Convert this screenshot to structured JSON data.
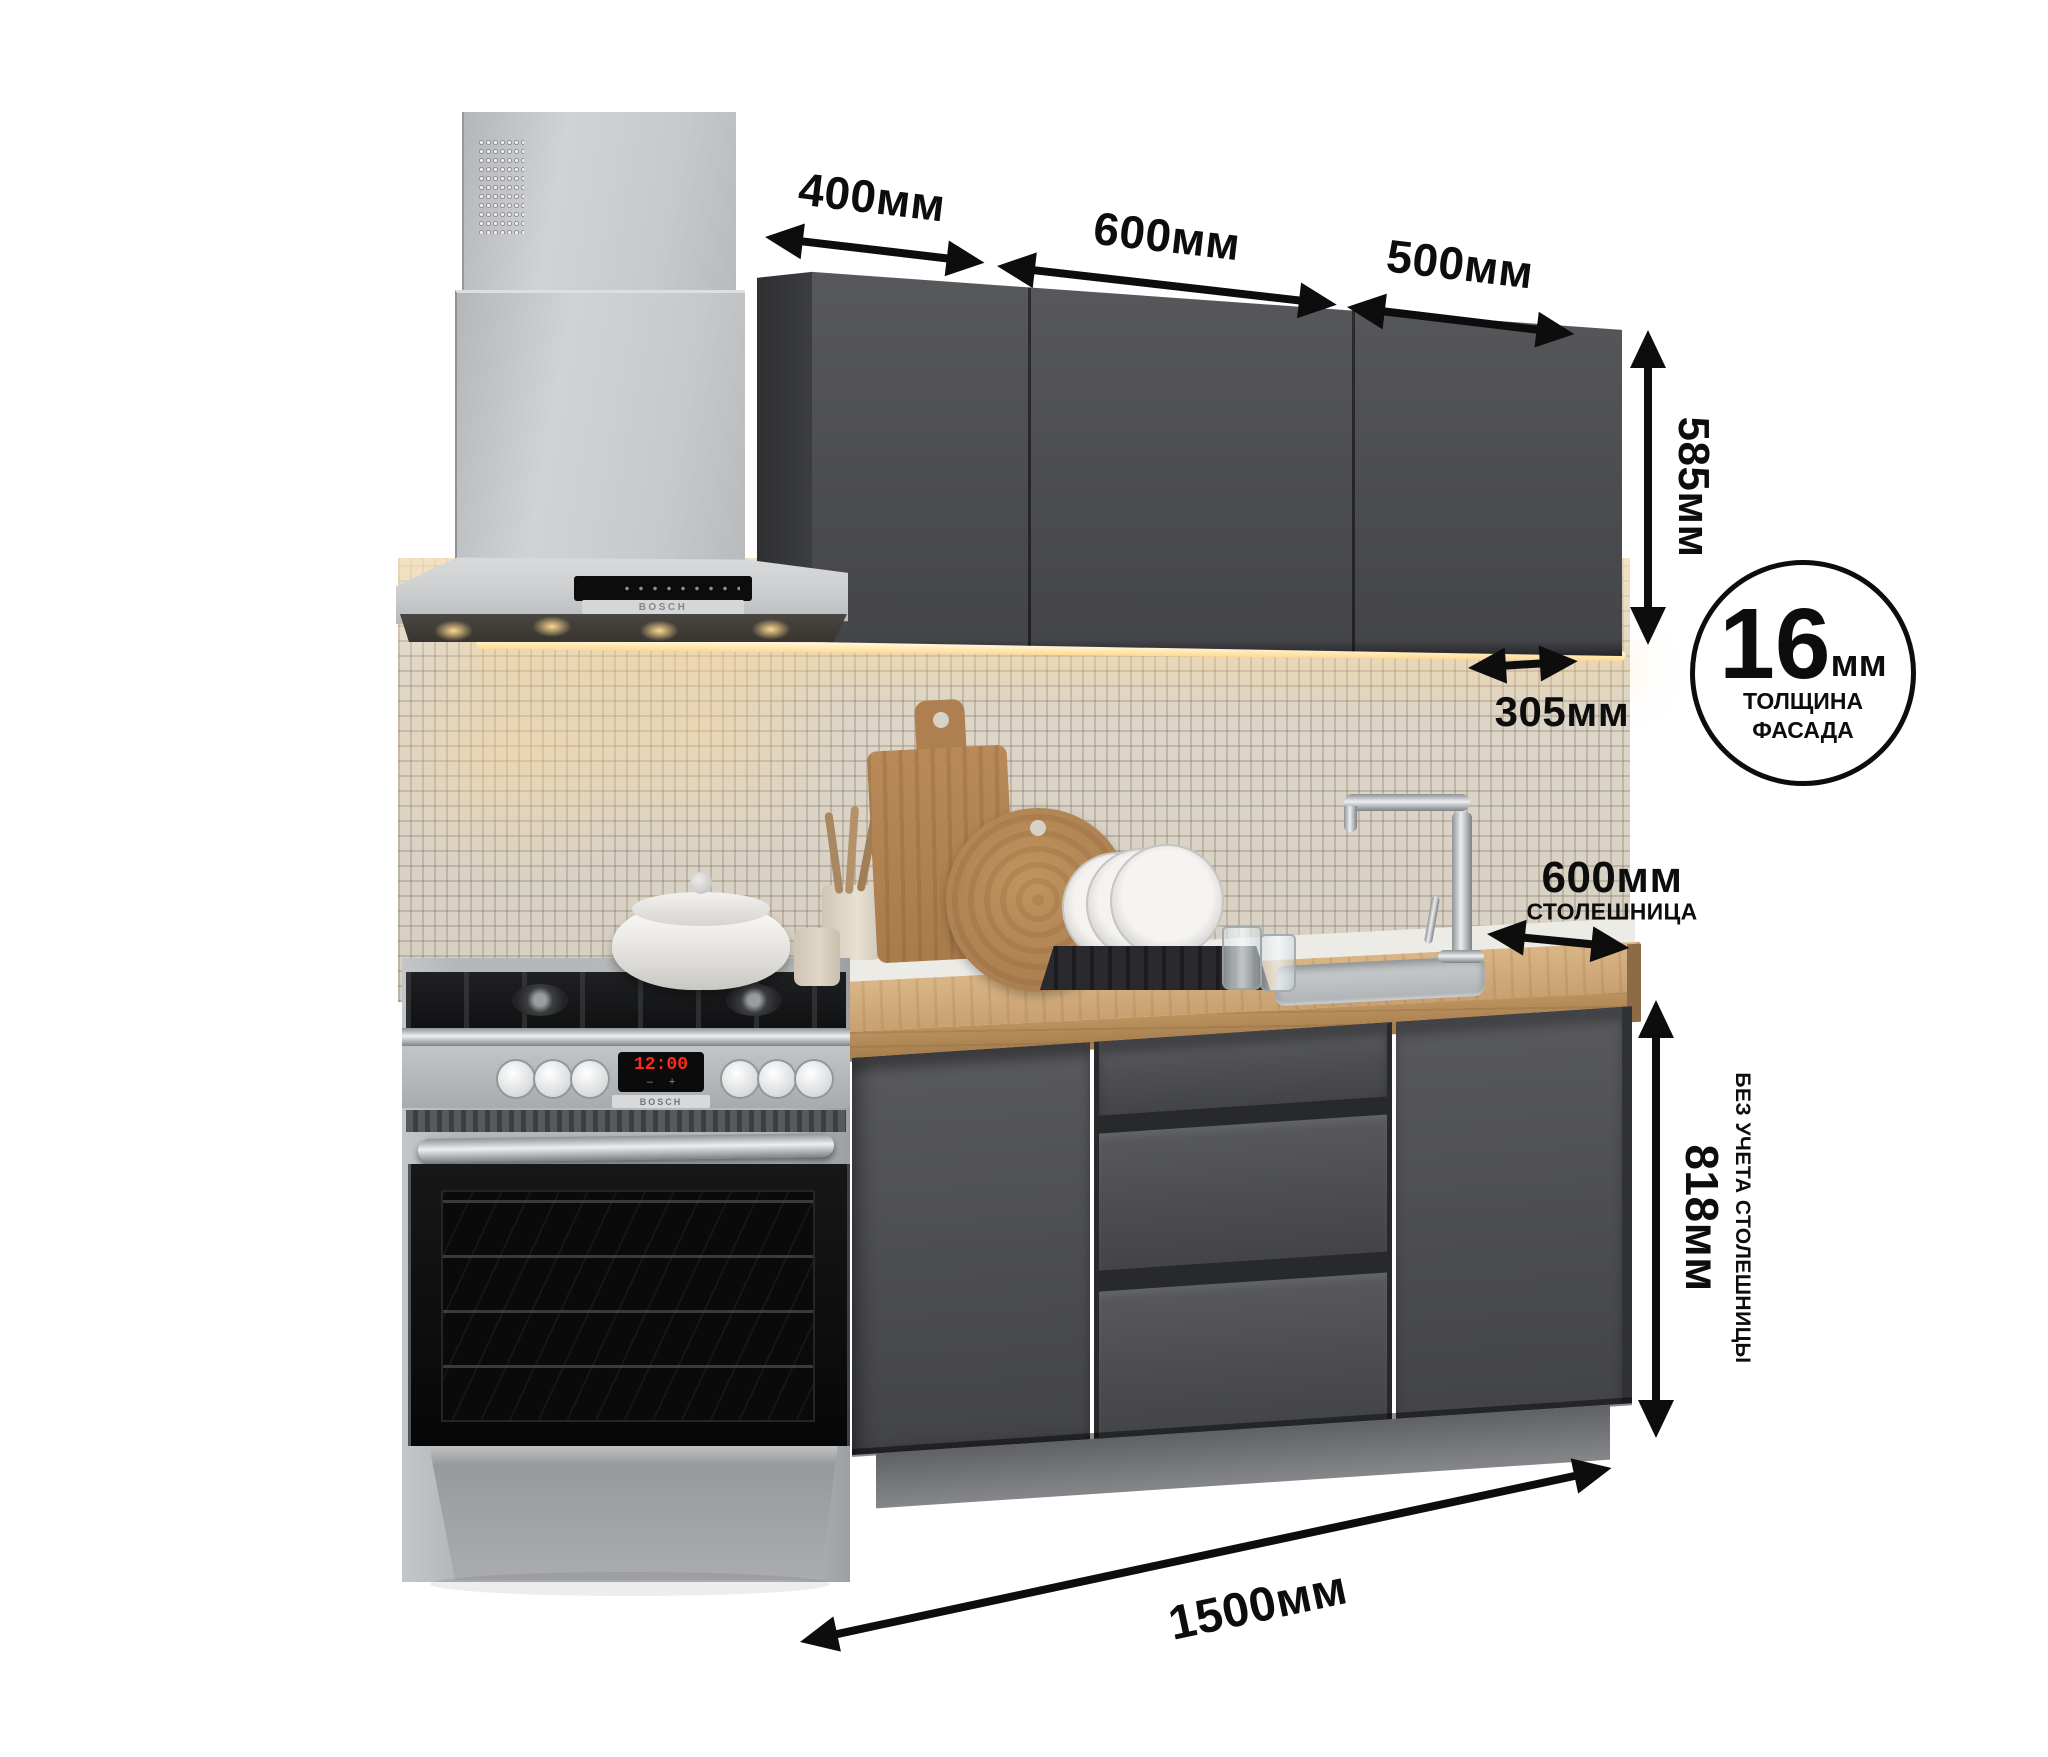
{
  "annotations": {
    "wall_widths": [
      {
        "label": "400мм"
      },
      {
        "label": "600мм"
      },
      {
        "label": "500мм"
      }
    ],
    "wall_height": "585мм",
    "wall_depth": "305мм",
    "counter_depth": "600мм",
    "counter_depth_caption": "СТОЛЕШНИЦА",
    "base_height": "818мм",
    "base_height_caption": "БЕЗ УЧЕТА СТОЛЕШНИЦЫ",
    "total_width": "1500мм",
    "badge": {
      "value": "16",
      "unit": "мм",
      "line1": "ТОЛЩИНА",
      "line2": "ФАСАДА"
    }
  },
  "appliances": {
    "hood_brand": "BOSCH",
    "stove_brand": "BOSCH",
    "stove_clock": "12:00",
    "stove_minus": "–",
    "stove_plus": "+"
  },
  "colors": {
    "facade_graphite": "#4e4f53",
    "countertop_wood": "#cfa97b",
    "backsplash_tile": "#dbd4c7",
    "steel": "#c6c8ca",
    "annotation_black": "#0d0d0d",
    "led_warm": "#ffd98f",
    "clock_red": "#ff2a1f"
  }
}
